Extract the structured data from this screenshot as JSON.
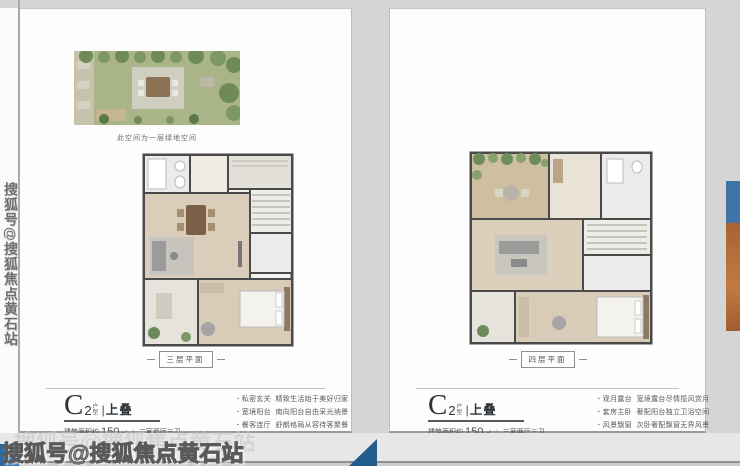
{
  "watermark": {
    "text": "搜狐号@搜狐焦点黄石站"
  },
  "ui": {
    "bullet": "▪"
  },
  "left_page": {
    "garden_caption": "此空间为一层绿地空间",
    "floor_tag": "三层平面",
    "unit": {
      "letter": "C",
      "number": "2",
      "label_small": "户型",
      "sep": "|",
      "suffix": "上叠"
    },
    "area": {
      "prefix": "建筑面积约",
      "value": "150",
      "unit": "㎡",
      "sep": "|",
      "layout": "三室两厅三卫"
    },
    "features": [
      "私密玄关  精致生活始于美好归家",
      "宽境阳台  南向阳台自由采光纳景",
      "餐客连厅  舒朗格局从容待客聚餐"
    ]
  },
  "right_page": {
    "floor_tag": "四层平面",
    "unit": {
      "letter": "C",
      "number": "2",
      "label_small": "户型",
      "sep": "|",
      "suffix": "上叠"
    },
    "area": {
      "prefix": "建筑面积约",
      "value": "150",
      "unit": "㎡",
      "sep": "|",
      "layout": "三室两厅三卫"
    },
    "features": [
      "观月露台  宽境露台尽情揽风赏月",
      "套房主卧  奢配阳台独立卫浴空间",
      "风景飘窗  次卧奢配飘窗无界风景"
    ]
  },
  "colors": {
    "accent_blue": "#2a6aa2",
    "fragment_orange": "#b5713c",
    "page_bg": "#fdfdfd",
    "canvas_bg": "#d5d5d5",
    "wall": "#4a4a4a",
    "wood_floor": "#dacdba",
    "plant_green": "#6d8b5a"
  }
}
